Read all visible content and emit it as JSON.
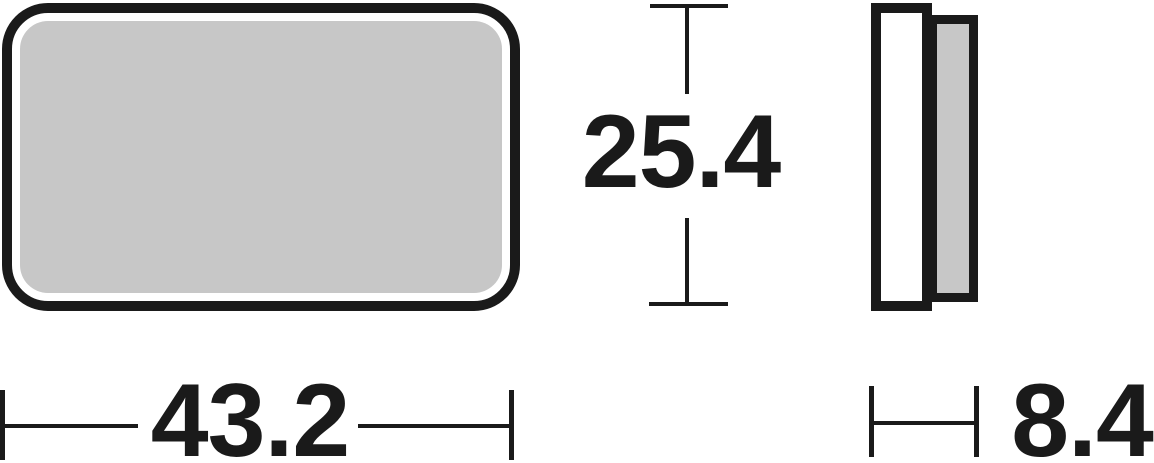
{
  "dimensions": {
    "height": {
      "label": "25.4"
    },
    "width": {
      "label": "43.2"
    },
    "thickness": {
      "label": "8.4"
    }
  },
  "colors": {
    "line": "#1a1a1a",
    "friction_fill": "#c7c7c7",
    "plate_fill": "#ffffff",
    "background": "#ffffff"
  }
}
